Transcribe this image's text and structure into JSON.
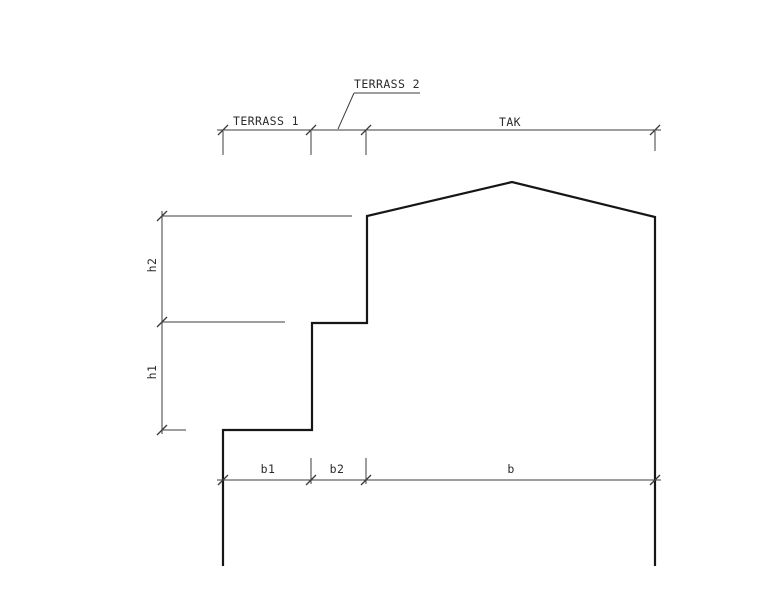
{
  "diagram": {
    "type": "architectural-section-elevation",
    "top_dimension": {
      "spans": [
        {
          "label": "TERRASS 1"
        },
        {
          "label": "TERRASS 2"
        },
        {
          "label": "TAK"
        }
      ]
    },
    "vertical_dimension": {
      "spans": [
        {
          "label": "h2"
        },
        {
          "label": "h1"
        }
      ]
    },
    "bottom_dimension": {
      "spans": [
        {
          "label": "b1"
        },
        {
          "label": "b2"
        },
        {
          "label": "b"
        }
      ]
    },
    "colors": {
      "background": "#ffffff",
      "outline": "#161616",
      "dimension": "#3c3c3c",
      "text": "#2b2b2b"
    }
  }
}
